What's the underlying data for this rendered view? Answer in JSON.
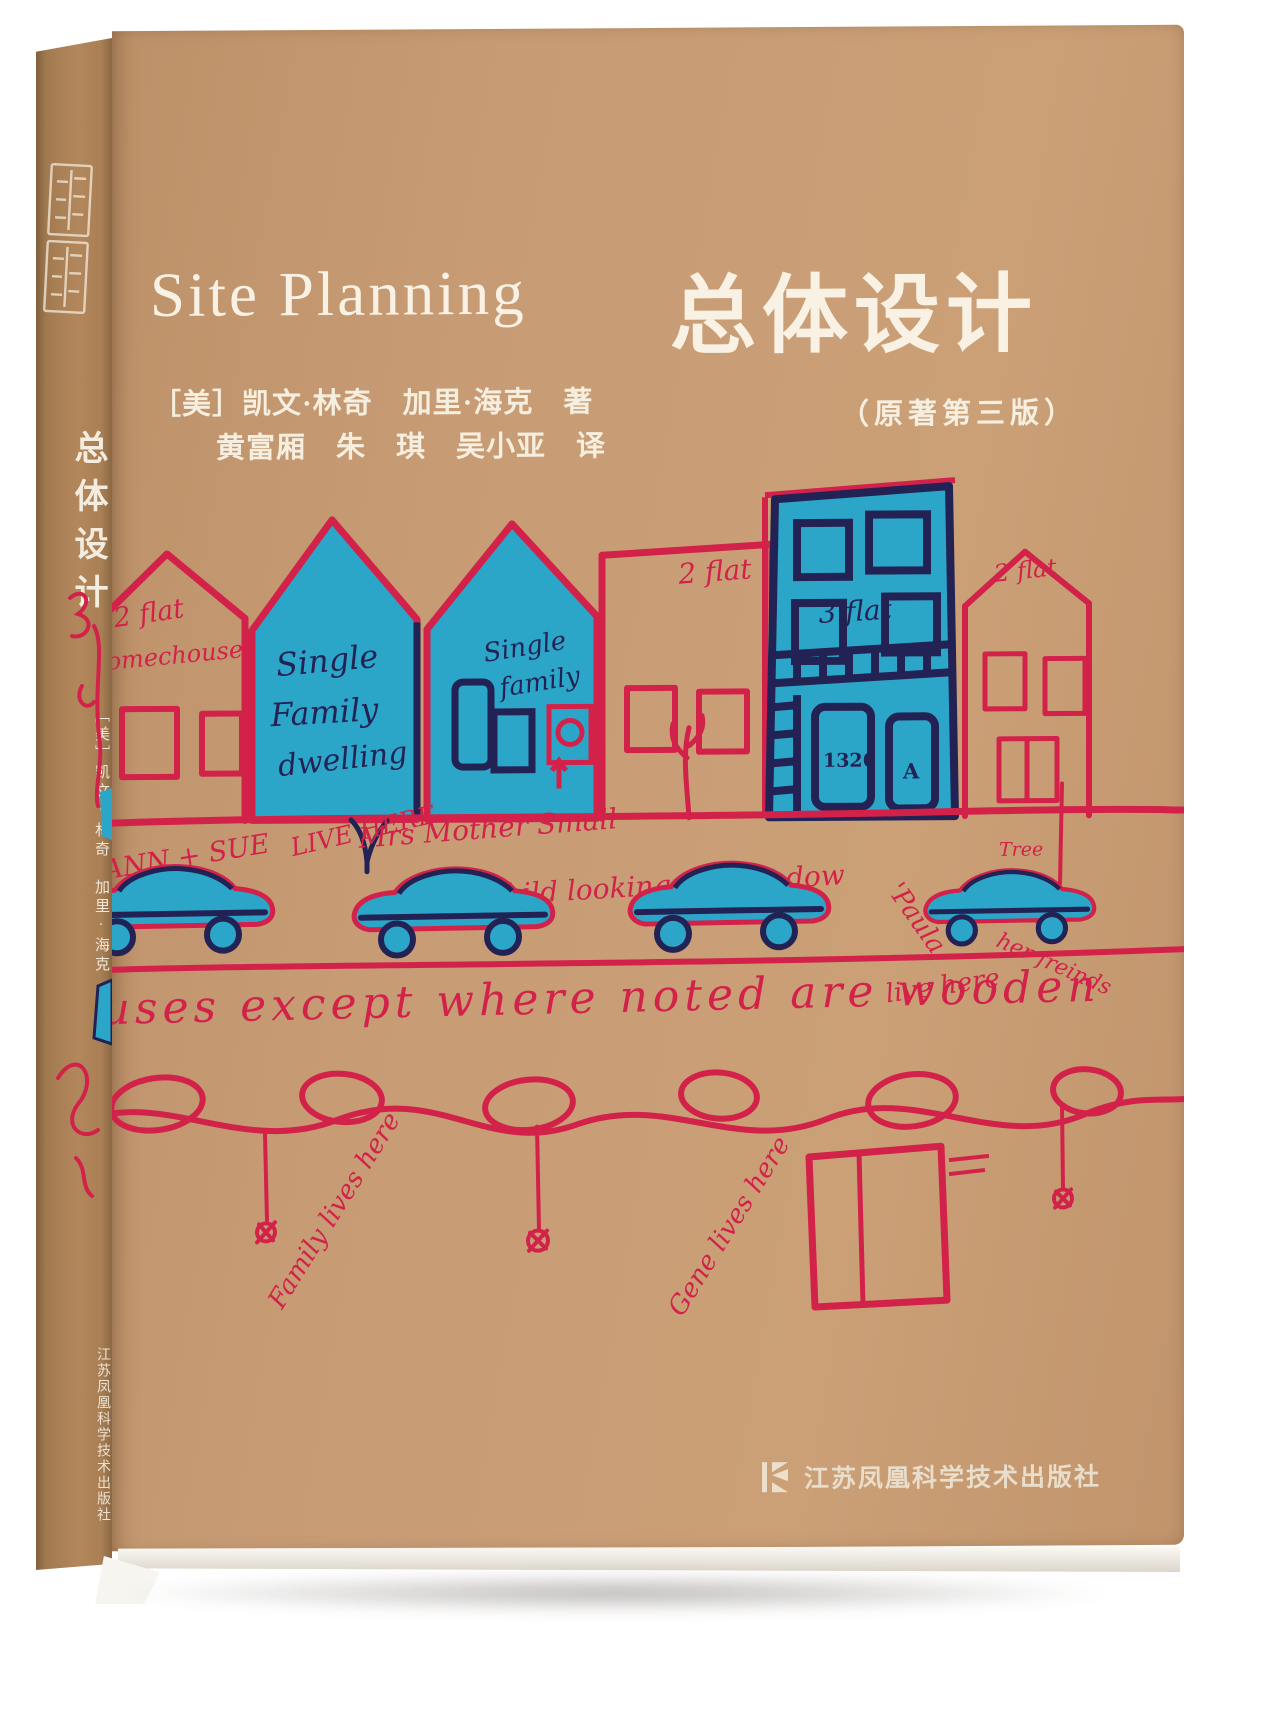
{
  "colors": {
    "cover_tan": "#c79b74",
    "spine_tan": "#a37a50",
    "ink_red": "#d2224a",
    "ink_blue": "#2ba6c8",
    "ink_navy": "#232254",
    "text_cream": "#f8f1e4"
  },
  "spine": {
    "title": "总体设计",
    "authors": "［美］凯文·林奇　加里·海克　著",
    "publisher": "江苏凤凰科学技术出版社"
  },
  "cover": {
    "title_en": "Site Planning",
    "authors_line": "［美］凯文·林奇　加里·海克　著",
    "translators_line": "黄富厢　朱　琪　吴小亚　译",
    "title_zh": "总体设计",
    "edition": "（原著第三版）",
    "publisher": "江苏凤凰科学技术出版社"
  },
  "art": {
    "house1_l1": "2 flat",
    "house1_l2": "Somechouse",
    "house2_l1": "Single",
    "house2_l2": "Family",
    "house2_l3": "dwelling",
    "house3_l1": "Single",
    "house3_l2": "family",
    "house4_label": "2 flat",
    "house5_label": "3 flat",
    "house5_number": "1326",
    "house5_letter": "A",
    "house6_label": "2 flat",
    "hw_ann": "ANN + SUE",
    "hw_live": "LIVE HERE",
    "hw_mother": "Mrs Mother Small",
    "hw_child": "child looking out window",
    "hw_tree1": "Tree",
    "hw_tree2": "Tree",
    "hw_paula": "'Paula",
    "hw_friends": "her freinds",
    "hw_livehere": "live here",
    "hw_myfront": "my front",
    "hw_sentence": "houses except where noted are wooden",
    "hw_sign1": "Family lives here",
    "hw_sign2": "Gene lives here"
  }
}
